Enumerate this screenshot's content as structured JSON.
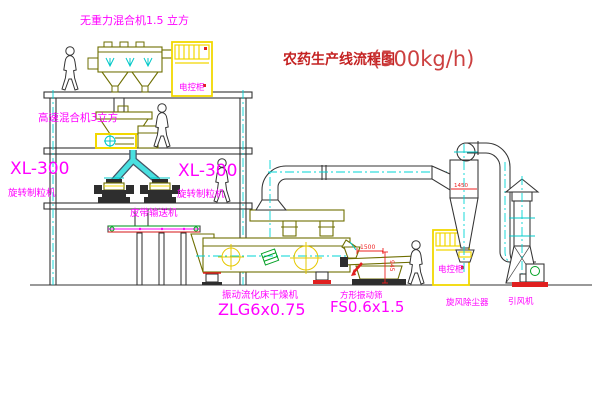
{
  "title": {
    "name_zh": "农药生产线流程图",
    "capacity": "(500kg/h)"
  },
  "labels": {
    "top_mixer": "无重力混合机1.5 立方",
    "high_speed_mixer": "高速混合机3立方",
    "granulator_model_left": "XL-300",
    "granulator_type_left": "旋转制粒机",
    "granulator_model_center": "XL-300",
    "granulator_type_center": "旋转制粒机",
    "belt_conveyor": "皮带输送机",
    "dryer_name": "振动流化床干燥机",
    "dryer_model": "ZLG6x0.75",
    "sieve_name": "方形振动筛",
    "sieve_model": "FS0.6x1.5",
    "cyclone": "旋风除尘器",
    "induced_draft_fan": "引风机",
    "control_cabinet_1": "电控柜",
    "control_cabinet_2": "电控柜"
  },
  "dimensions": {
    "sieve_length": "1500",
    "sieve_height": "945",
    "cyclone_width": "1450"
  },
  "colors": {
    "label": "#ff00ff",
    "title": "#c42222",
    "title_capacity": "#cc4040",
    "dimension": "#ee2222",
    "equipment": "#6e6e00",
    "structure": "#333333",
    "centerline": "#00d5d5",
    "cabinet": "#f2d800"
  }
}
